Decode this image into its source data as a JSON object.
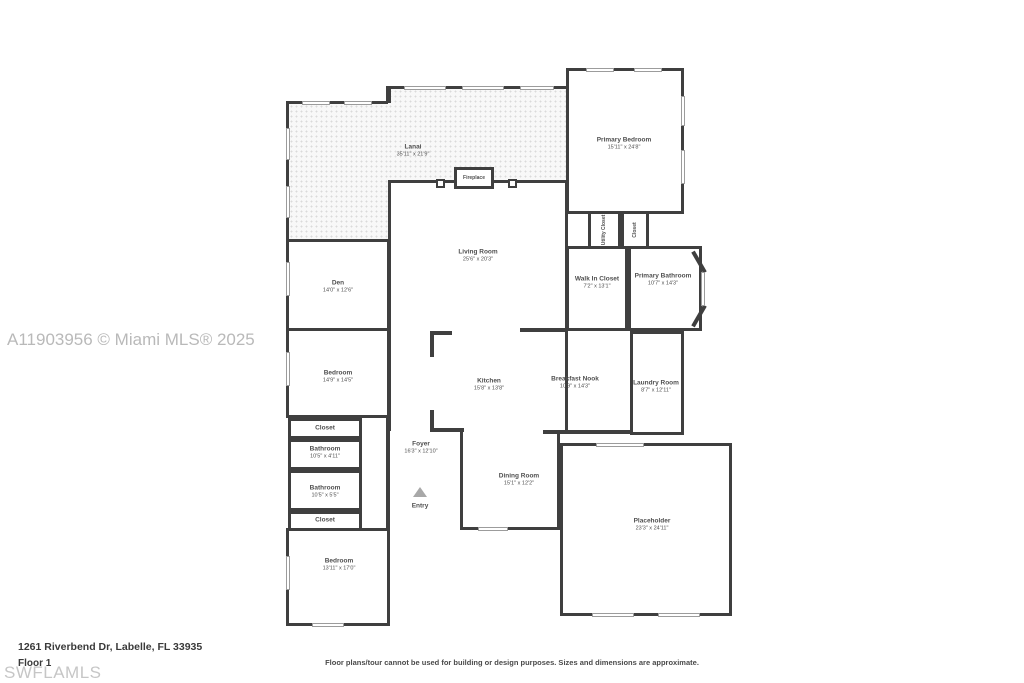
{
  "colors": {
    "wall": "#3f3f3f",
    "watermark": "#b9b9b9",
    "label": "#4f4f4f"
  },
  "watermarks": {
    "mls": "A11903956 © Miami MLS® 2025",
    "swflamls": "SWFLAMLS"
  },
  "footer": {
    "address": "1261 Riverbend Dr, Labelle, FL 33935",
    "floor": "Floor 1",
    "disclaimer": "Floor plans/tour cannot be used for building or design purposes. Sizes and dimensions are approximate."
  },
  "rooms": [
    {
      "name": "Lanai",
      "dims": "35'11\" x 21'9\""
    },
    {
      "name": "Primary Bedroom",
      "dims": "15'11\" x 24'8\""
    },
    {
      "name": "Living Room",
      "dims": "25'6\" x 20'3\""
    },
    {
      "name": "Den",
      "dims": "14'0\" x 12'6\""
    },
    {
      "name": "Bedroom",
      "dims": "14'9\" x 14'5\""
    },
    {
      "name": "Walk In Closet",
      "dims": "7'2\" x 13'1\""
    },
    {
      "name": "Primary Bathroom",
      "dims": "10'7\" x 14'3\""
    },
    {
      "name": "Utility Closet"
    },
    {
      "name": "Closet"
    },
    {
      "name": "Kitchen",
      "dims": "15'8\" x 13'8\""
    },
    {
      "name": "Breakfast Nook",
      "dims": "10'9\" x 14'3\""
    },
    {
      "name": "Laundry Room",
      "dims": "8'7\" x 12'11\""
    },
    {
      "name": "Closet"
    },
    {
      "name": "Bathroom",
      "dims": "10'5\" x 4'11\""
    },
    {
      "name": "Bathroom",
      "dims": "10'5\" x 5'5\""
    },
    {
      "name": "Closet"
    },
    {
      "name": "Bedroom",
      "dims": "13'11\" x 17'0\""
    },
    {
      "name": "Foyer",
      "dims": "16'3\" x 12'10\""
    },
    {
      "name": "Dining Room",
      "dims": "15'1\" x 12'2\""
    },
    {
      "name": "Placeholder",
      "dims": "23'3\" x 24'11\""
    }
  ],
  "features": {
    "fireplace": "Fireplace",
    "entry": "Entry"
  }
}
